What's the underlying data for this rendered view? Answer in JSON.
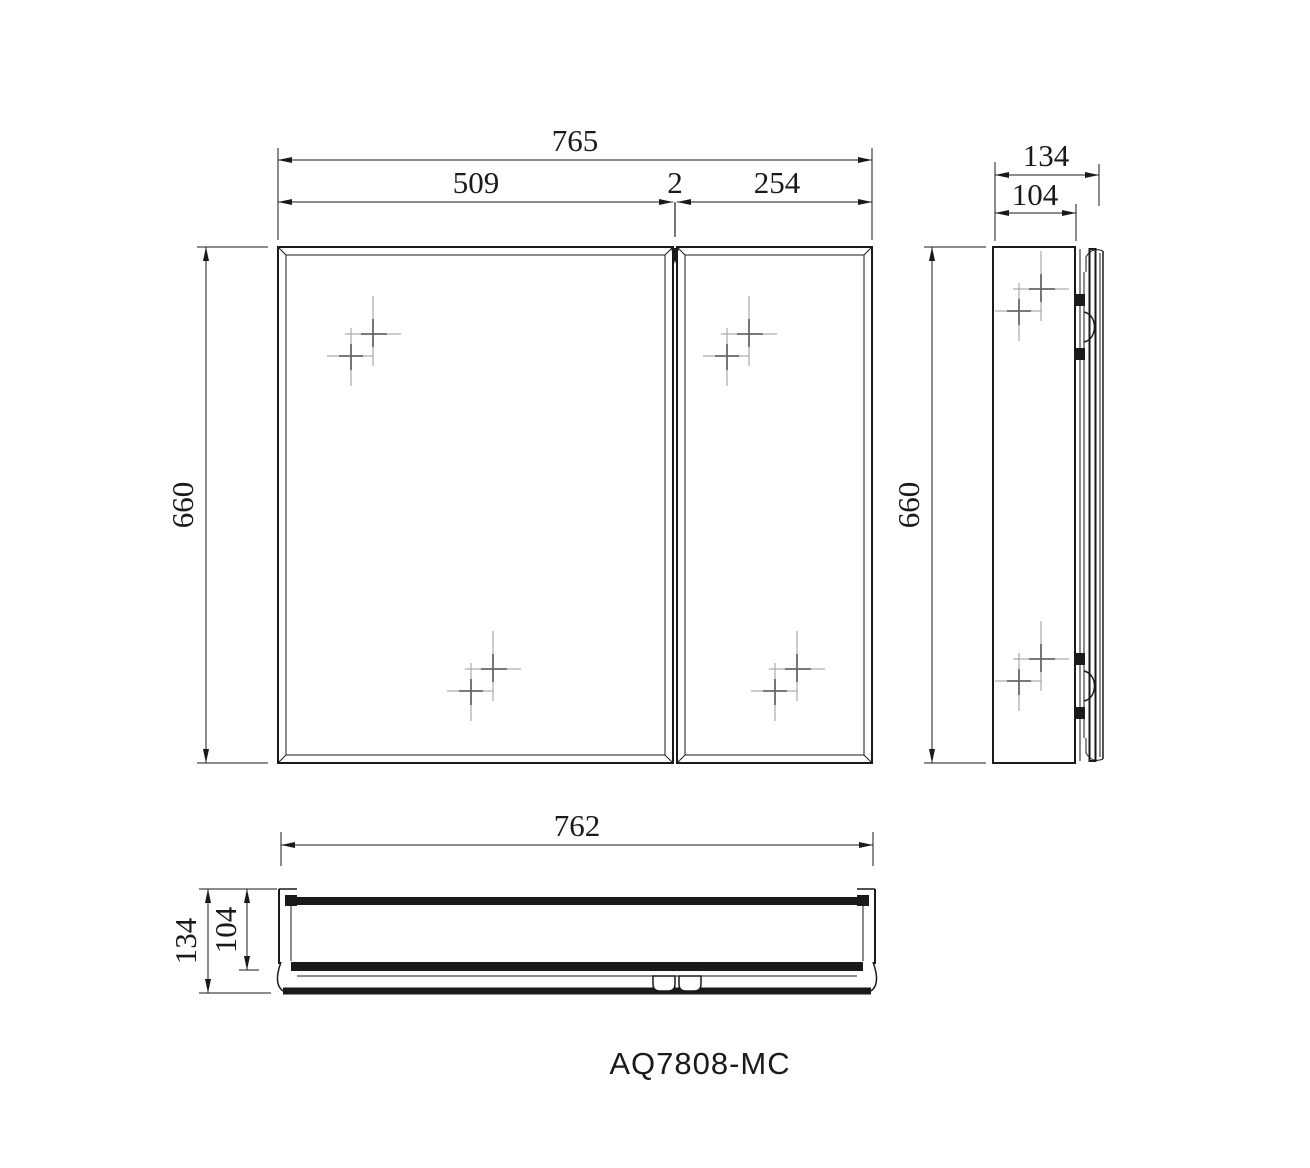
{
  "colors": {
    "line": "#1a1a1a",
    "background": "#ffffff",
    "glint": "#9a9a9a"
  },
  "model_label": "AQ7808-MC",
  "front_view": {
    "total_width": "765",
    "left_door_width": "509",
    "door_gap": "2",
    "right_door_width": "254",
    "height": "660"
  },
  "side_view": {
    "total_depth": "134",
    "body_depth": "104",
    "height": "660"
  },
  "bottom_view": {
    "width": "762",
    "total_depth": "134",
    "body_depth": "104"
  }
}
